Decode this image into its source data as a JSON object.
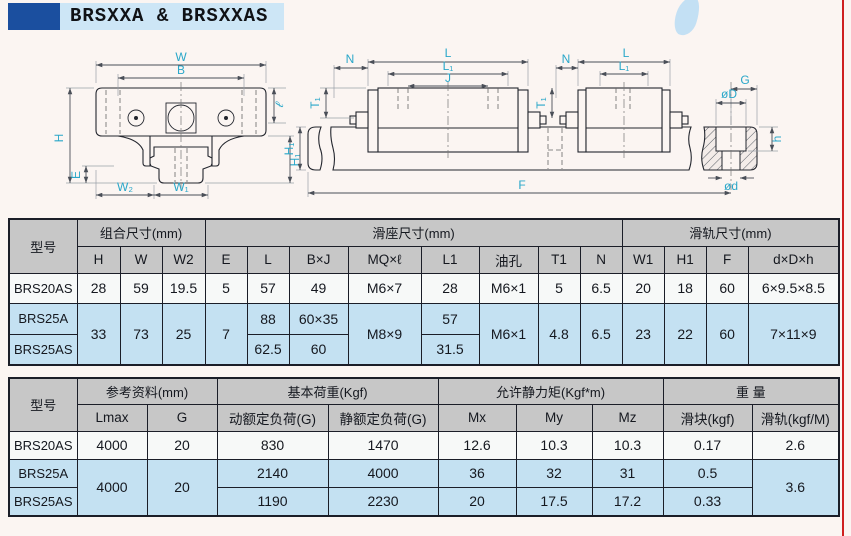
{
  "page": {
    "title": "BRSXXA & BRSXXAS",
    "colors": {
      "accent_square": "#1b4f9f",
      "title_bg": "#cde6f6",
      "header_gray": "#c7c7c7",
      "row_white": "#f7f9f8",
      "row_blue": "#c4e1f2",
      "table_border": "#1b1e28",
      "dim_label": "#2aa7c9",
      "red_border": "#cf2020"
    }
  },
  "dim": {
    "w": "W",
    "b": "B",
    "hh": "H",
    "e": "E",
    "w2": "W₂",
    "w1": "W₁",
    "ell": "ℓ",
    "h1f": "H₁",
    "n1": "N",
    "lL": "L",
    "l1L": "L₁",
    "j": "J",
    "t1a": "T₁",
    "h1s": "H₁",
    "n2": "N",
    "t1b": "T₁",
    "lS": "L",
    "l1S": "L₁",
    "g": "G",
    "dD": "øD",
    "hs": "h",
    "dd": "ød",
    "f": "F"
  },
  "t1": {
    "h_model": "型号",
    "g1": "组合尺寸(mm)",
    "g2": "滑座尺寸(mm)",
    "g3": "滑轨尺寸(mm)",
    "c": {
      "h": "H",
      "w": "W",
      "w2": "W2",
      "e": "E",
      "l": "L",
      "bj": "B×J",
      "mq": "MQ×ℓ",
      "l1": "L1",
      "oil": "油孔",
      "t1": "T1",
      "n": "N",
      "w1": "W1",
      "h1": "H1",
      "f": "F",
      "ddh": "d×D×h"
    },
    "r1": {
      "model": "BRS20AS",
      "h": "28",
      "w": "59",
      "w2": "19.5",
      "e": "5",
      "l": "57",
      "bj": "49",
      "mq": "M6×7",
      "l1": "28",
      "oil": "M6×1",
      "t1": "5",
      "n": "6.5",
      "w1": "20",
      "h1": "18",
      "f": "60",
      "ddh": "6×9.5×8.5"
    },
    "r2": {
      "model": "BRS25A",
      "l": "88",
      "bj": "60×35",
      "l1": "57"
    },
    "r3": {
      "model": "BRS25AS",
      "l": "62.5",
      "bj": "60",
      "l1": "31.5"
    },
    "m": {
      "h": "33",
      "w": "73",
      "w2": "25",
      "e": "7",
      "mq": "M8×9",
      "oil": "M6×1",
      "t1": "4.8",
      "n": "6.5",
      "w1": "23",
      "h1": "22",
      "f": "60",
      "ddh": "7×11×9"
    }
  },
  "t2": {
    "h_model": "型号",
    "g1": "参考资料(mm)",
    "g2": "基本荷重(Kgf)",
    "g3": "允许静力矩(Kgf*m)",
    "g4": "重 量",
    "c": {
      "lmax": "Lmax",
      "g": "G",
      "dyn": "动额定负荷(G)",
      "stat": "静额定负荷(G)",
      "mx": "Mx",
      "my": "My",
      "mz": "Mz",
      "block": "滑块(kgf)",
      "rail": "滑轨(kgf/M)"
    },
    "r1": {
      "model": "BRS20AS",
      "lmax": "4000",
      "g": "20",
      "dyn": "830",
      "stat": "1470",
      "mx": "12.6",
      "my": "10.3",
      "mz": "10.3",
      "block": "0.17",
      "rail": "2.6"
    },
    "r2": {
      "model": "BRS25A",
      "dyn": "2140",
      "stat": "4000",
      "mx": "36",
      "my": "32",
      "mz": "31",
      "block": "0.5"
    },
    "r3": {
      "model": "BRS25AS",
      "dyn": "1190",
      "stat": "2230",
      "mx": "20",
      "my": "17.5",
      "mz": "17.2",
      "block": "0.33"
    },
    "m": {
      "lmax": "4000",
      "g": "20",
      "rail": "3.6"
    }
  }
}
